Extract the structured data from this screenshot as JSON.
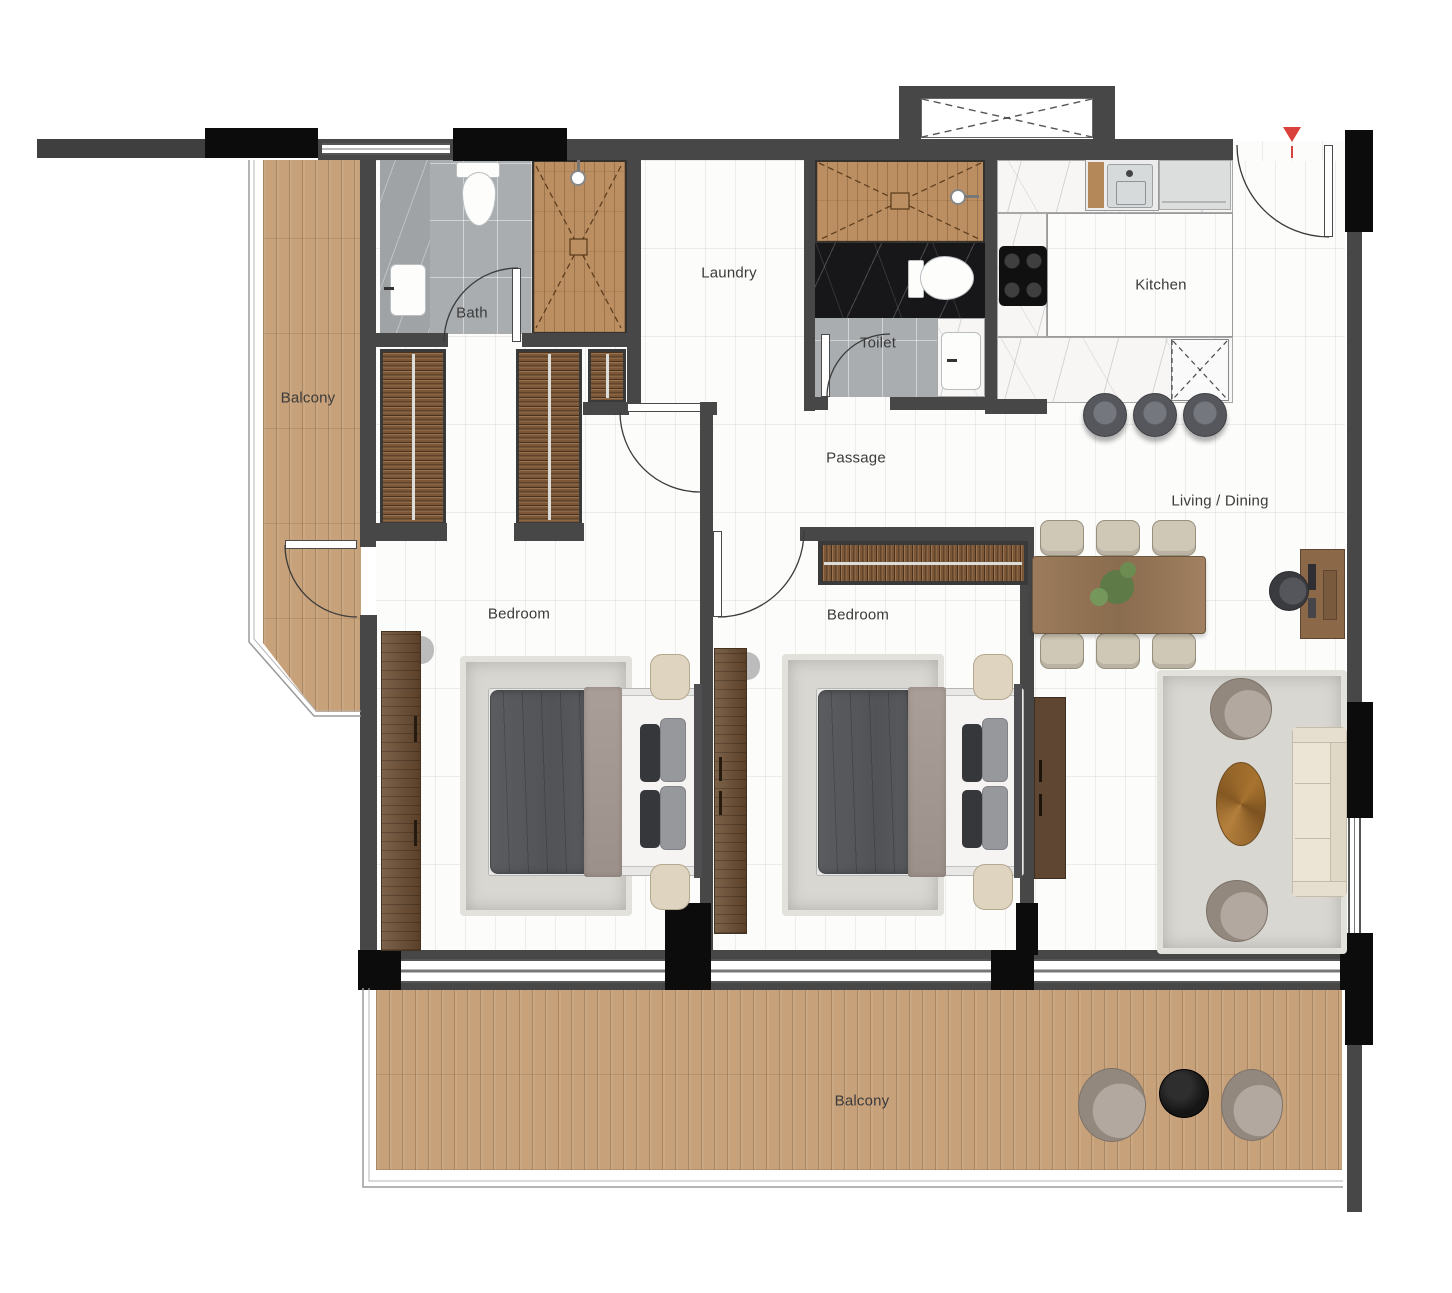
{
  "plan": {
    "type": "apartment-floor-plan",
    "rooms": {
      "balcony_left": {
        "label": "Balcony"
      },
      "bath": {
        "label": "Bath"
      },
      "laundry": {
        "label": "Laundry"
      },
      "toilet": {
        "label": "Toilet"
      },
      "kitchen": {
        "label": "Kitchen"
      },
      "passage": {
        "label": "Passage"
      },
      "bedroom_1": {
        "label": "Bedroom"
      },
      "bedroom_2": {
        "label": "Bedroom"
      },
      "living_dining": {
        "label": "Living / Dining"
      },
      "balcony_bottom": {
        "label": "Balcony"
      }
    },
    "colors": {
      "wall": "#474747",
      "wall_black": "#0c0c0c",
      "wood_light": "#c7a17a",
      "wood_dark": "#6b4c31",
      "floor_white": "#fcfcfb",
      "tile_gray": "#a9adb0",
      "marble_black": "#17171a",
      "rug_gray": "#d9d7d2",
      "cream": "#ded4c0",
      "sofa_cream": "#ece5d6",
      "entry_accent": "#d9413d"
    },
    "markers": {
      "entry": "entry-arrow"
    }
  }
}
